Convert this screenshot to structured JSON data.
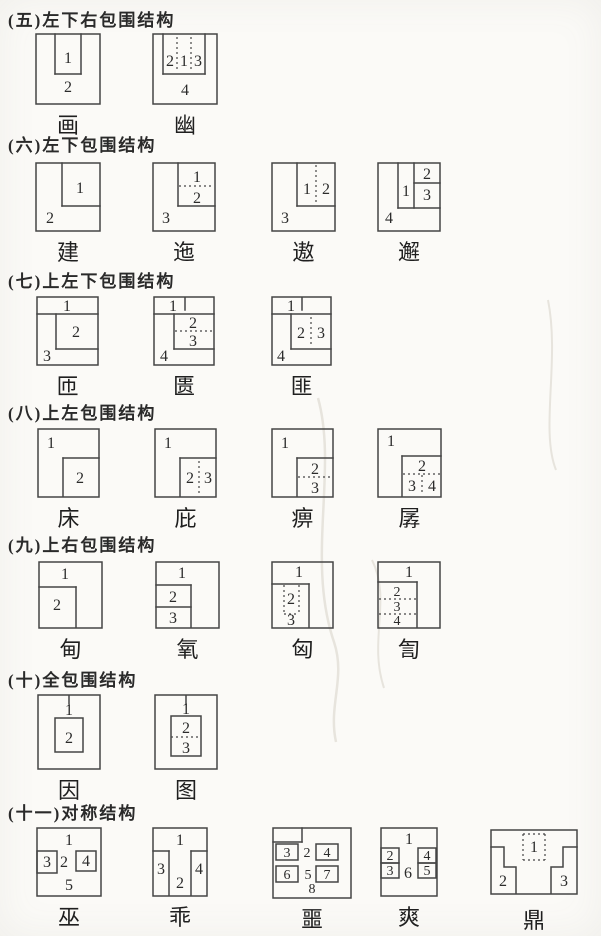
{
  "colors": {
    "paper": "#fbfaf7",
    "ink": "#454545",
    "digit": "#2b2b2b",
    "smudge": "#e7e4dd"
  },
  "sections": [
    {
      "title": "(五)左下右包围结构",
      "items": [
        {
          "char": "画",
          "parts": [
            "1",
            "2"
          ]
        },
        {
          "char": "幽",
          "parts": [
            "2",
            "1",
            "3",
            "4"
          ]
        }
      ]
    },
    {
      "title": "(六)左下包围结构",
      "items": [
        {
          "char": "建",
          "parts": [
            "1",
            "2"
          ]
        },
        {
          "char": "迤",
          "parts": [
            "1",
            "2",
            "3"
          ]
        },
        {
          "char": "遨",
          "parts": [
            "1",
            "2",
            "3"
          ]
        },
        {
          "char": "邂",
          "parts": [
            "1",
            "2",
            "3",
            "4"
          ]
        }
      ]
    },
    {
      "title": "(七)上左下包围结构",
      "items": [
        {
          "char": "匝",
          "parts": [
            "1",
            "2",
            "3"
          ]
        },
        {
          "char": "匮",
          "parts": [
            "1",
            "2",
            "3",
            "4"
          ]
        },
        {
          "char": "匪",
          "parts": [
            "1",
            "2",
            "3",
            "4"
          ]
        }
      ]
    },
    {
      "title": "(八)上左包围结构",
      "items": [
        {
          "char": "床",
          "parts": [
            "1",
            "2"
          ]
        },
        {
          "char": "庇",
          "parts": [
            "1",
            "2",
            "3"
          ]
        },
        {
          "char": "痹",
          "parts": [
            "1",
            "2",
            "3"
          ]
        },
        {
          "char": "孱",
          "parts": [
            "1",
            "2",
            "3",
            "4"
          ]
        }
      ]
    },
    {
      "title": "(九)上右包围结构",
      "items": [
        {
          "char": "甸",
          "parts": [
            "1",
            "2"
          ]
        },
        {
          "char": "氧",
          "parts": [
            "1",
            "2",
            "3"
          ]
        },
        {
          "char": "匈",
          "parts": [
            "1",
            "2",
            "3"
          ]
        },
        {
          "char": "訇",
          "parts": [
            "1",
            "2",
            "3",
            "4"
          ]
        }
      ]
    },
    {
      "title": "(十)全包围结构",
      "items": [
        {
          "char": "因",
          "parts": [
            "1",
            "2"
          ]
        },
        {
          "char": "图",
          "parts": [
            "1",
            "2",
            "3"
          ]
        }
      ]
    },
    {
      "title": "(十一)对称结构",
      "items": [
        {
          "char": "巫",
          "parts": [
            "1",
            "2",
            "3",
            "4",
            "5"
          ]
        },
        {
          "char": "乖",
          "parts": [
            "1",
            "2",
            "3",
            "4"
          ]
        },
        {
          "char": "噩",
          "parts": [
            "2",
            "3",
            "4",
            "5",
            "6",
            "7",
            "8"
          ]
        },
        {
          "char": "爽",
          "parts": [
            "1",
            "2",
            "3",
            "4",
            "5",
            "6"
          ]
        },
        {
          "char": "鼎",
          "parts": [
            "1",
            "2",
            "3"
          ]
        }
      ]
    }
  ]
}
